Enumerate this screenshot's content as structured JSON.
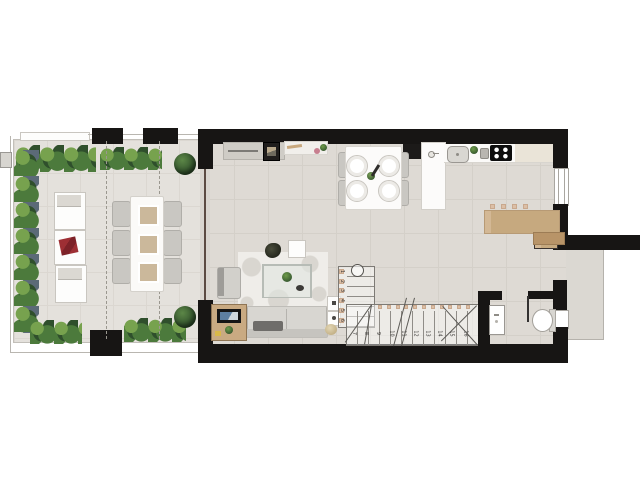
{
  "plan": {
    "type": "apartment-floor-plan",
    "stairs": {
      "flight_a_numbers": [
        "1",
        "2",
        "3",
        "4",
        "5",
        "6"
      ],
      "flight_b_numbers": [
        "7",
        "8",
        "9",
        "10",
        "11",
        "12",
        "13",
        "14",
        "15",
        "16"
      ]
    },
    "palette": {
      "wall": "#171514",
      "interior_floor": "#dedad4",
      "terrace_floor": "#e4e1dc",
      "wood": "#cdb28c",
      "plant_dark": "#2f4f2c",
      "plant_mid": "#4c7a3c",
      "plant_light": "#77a24e",
      "accent_red": "#9e2f34"
    },
    "icons": {
      "terrace": [
        "hedge-plants",
        "round-bush",
        "lounge-chair",
        "red-throw",
        "outdoor-dining-table",
        "outdoor-chair",
        "seat-pad",
        "roof-overhang-dashed-line",
        "ac-unit"
      ],
      "living_dining": [
        "sideboard",
        "wall-art",
        "decor-rod",
        "cutting-board",
        "flowers",
        "dining-table",
        "dining-chair",
        "plate",
        "plant-centerpiece",
        "pepper-mill",
        "rug",
        "coffee-table",
        "plant-pot",
        "armchair",
        "sofa",
        "throw-blanket",
        "tv-cabinet",
        "tv-screen",
        "side-table",
        "pouf"
      ],
      "kitchen": [
        "tall-cabinet",
        "island",
        "island-faucet",
        "countertop",
        "kitchen-sink",
        "herb-plant",
        "faucet",
        "cooktop",
        "breakfast-bar",
        "bar-stool"
      ],
      "bathroom": [
        "washbasin",
        "toilet",
        "door-leaf"
      ],
      "stairs": [
        "newel-circle",
        "step-nosing",
        "direction-line",
        "break-line"
      ],
      "openings": [
        "sliding-glass-door",
        "window",
        "entry-door"
      ]
    }
  }
}
